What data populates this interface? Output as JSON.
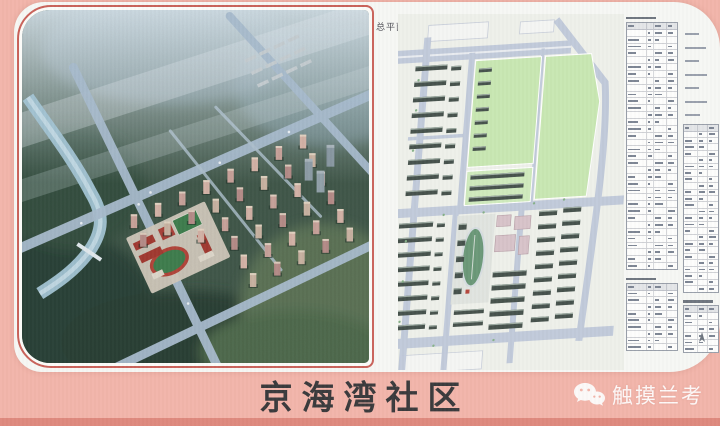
{
  "photo": {
    "frame_color": "#f2b5aa",
    "bottom_edge_color": "#de897e"
  },
  "board": {
    "aerial_panel": {
      "name": "aerial-rendering-of-community",
      "outline_color": "#c9625a"
    },
    "site_plan": {
      "label": "总平面图",
      "park_color": "#c8e7b2",
      "road_color": "#c0c9da"
    },
    "tables": {
      "column_a": [
        {
          "type": "caption"
        },
        {
          "type": "table",
          "rows": 36,
          "cols": [
            40,
            14,
            26,
            20
          ],
          "h": 246
        },
        {
          "type": "caption"
        },
        {
          "type": "table",
          "rows": 10,
          "cols": [
            40,
            14,
            26,
            20
          ],
          "h": 66
        }
      ],
      "column_b": [
        {
          "type": "notes",
          "lines": 7,
          "h": 84
        },
        {
          "type": "table",
          "rows": 26,
          "cols": [
            42,
            28,
            30
          ],
          "h": 168
        },
        {
          "type": "caption"
        },
        {
          "type": "table",
          "rows": 7,
          "cols": [
            42,
            28,
            30
          ],
          "h": 46
        }
      ]
    }
  },
  "footer": {
    "title": "京海湾社区",
    "watermark": {
      "label": "触摸兰考",
      "icon": "wechat-icon"
    }
  }
}
